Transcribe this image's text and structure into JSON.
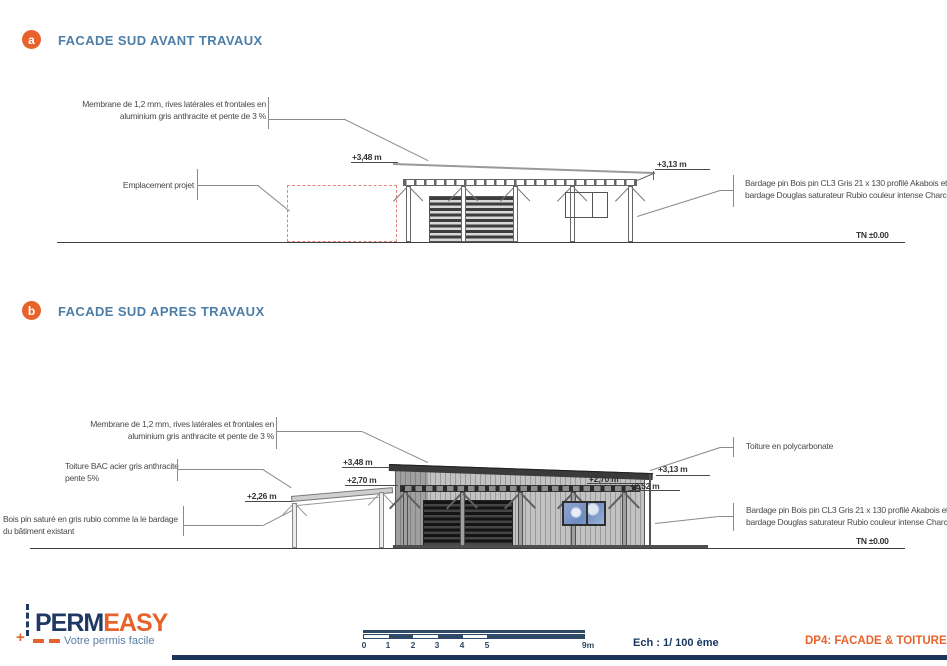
{
  "colors": {
    "accent_orange": "#E8632C",
    "heading_blue": "#4D7EA8",
    "navy": "#1F3864",
    "drawing_gray": "#5A5A5A",
    "red_dashed": "#E8837B"
  },
  "section_a": {
    "badge": "a",
    "title": "FACADE SUD AVANT TRAVAUX",
    "ann_membrane_l1": "Membrane de 1,2 mm, rives latérales et frontales en",
    "ann_membrane_l2": "aluminium gris anthracite et pente de 3 %",
    "ann_emplacement": "Emplacement projet",
    "ann_bardage_l1": "Bardage pin Bois pin CL3 Gris 21 x 130 profilé Akabois et",
    "ann_bardage_l2": "bardage Douglas saturateur Rubio couleur intense Charcoal",
    "dim_348": "+3,48 m",
    "dim_313": "+3,13 m",
    "tn": "TN ±0.00"
  },
  "section_b": {
    "badge": "b",
    "title": "FACADE SUD APRES TRAVAUX",
    "ann_membrane_l1": "Membrane de 1,2 mm, rives latérales et frontales en",
    "ann_membrane_l2": "aluminium gris anthracite et pente de 3 %",
    "ann_toiture_bac_l1": "Toiture BAC acier gris anthracite",
    "ann_toiture_bac_l2": "pente 5%",
    "ann_bois_l1": "Bois pin saturé en gris rubio comme la le bardage",
    "ann_bois_l2": "du bâtiment existant",
    "ann_polycarbonate": "Toiture en polycarbonate",
    "ann_bardage_l1": "Bardage pin Bois pin CL3 Gris 21 x 130 profilé Akabois et",
    "ann_bardage_l2": "bardage Douglas saturateur Rubio couleur intense Charcoal",
    "dim_348": "+3,48 m",
    "dim_270_left": "+2,70 m",
    "dim_226": "+2,26 m",
    "dim_270_right": "+2,70 m",
    "dim_252": "+2,52 m",
    "dim_313": "+3,13 m",
    "tn": "TN ±0.00"
  },
  "footer": {
    "logo_perm": "PERM",
    "logo_easy": "EASY",
    "tagline": "Votre permis facile",
    "scale_labels": [
      "0",
      "1",
      "2",
      "3",
      "4",
      "5"
    ],
    "scale_end": "9m",
    "scale_text": "Ech : 1/ 100 ème",
    "doc_ref": "DP4: FACADE & TOITURE"
  }
}
